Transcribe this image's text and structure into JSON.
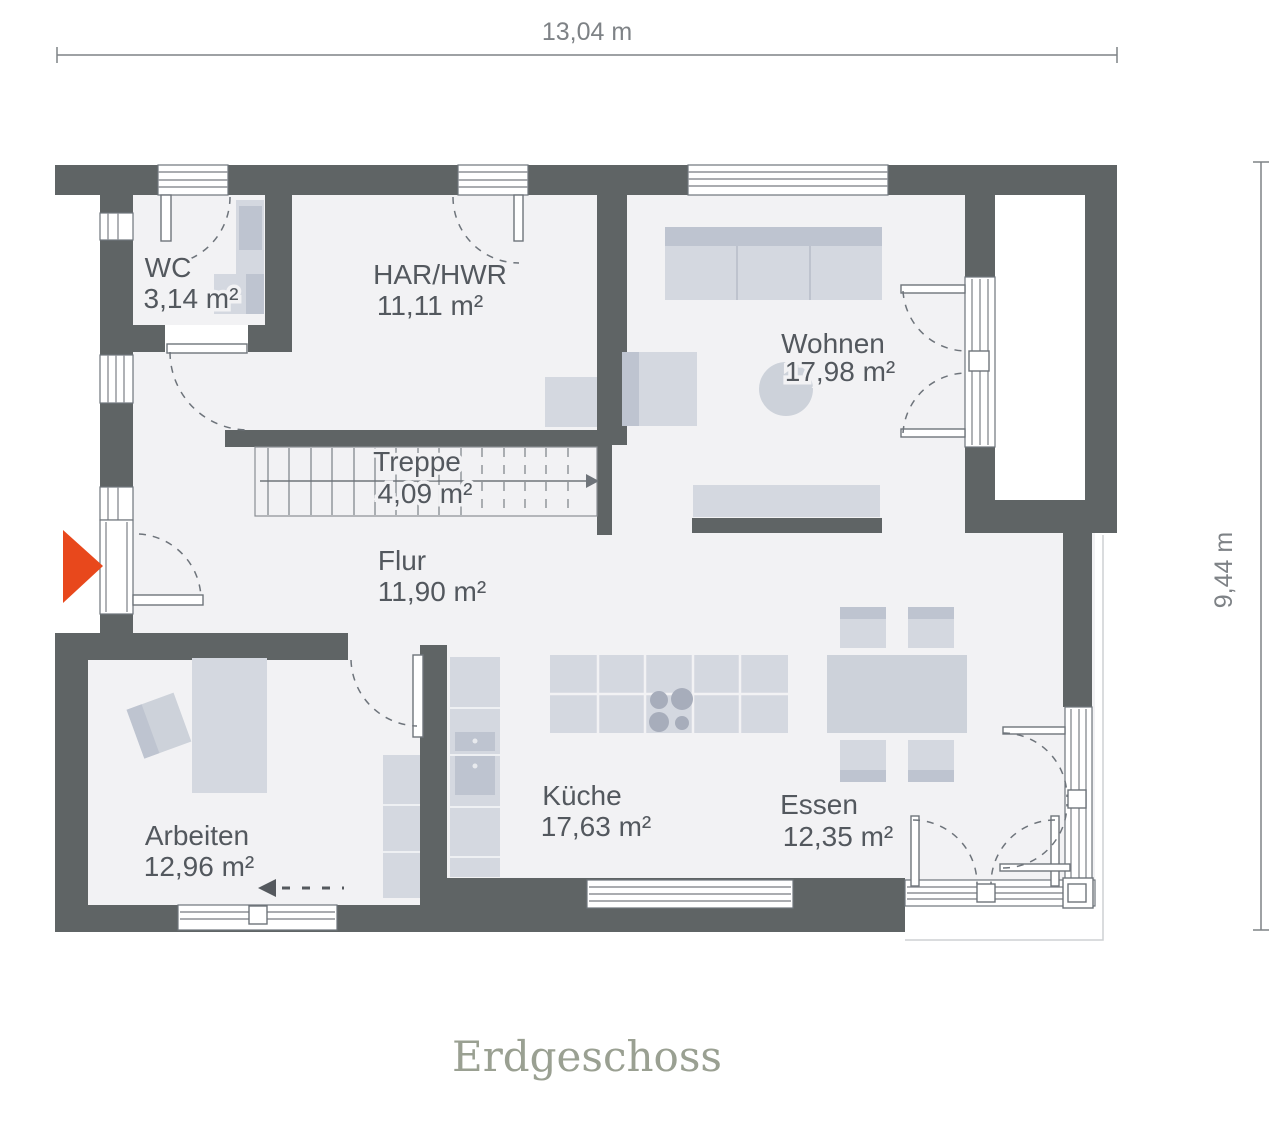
{
  "plan": {
    "title": "Erdgeschoss",
    "dim_width": "13,04 m",
    "dim_height": "9,44 m",
    "rooms": [
      {
        "name": "WC",
        "area": "3,14 m²"
      },
      {
        "name": "HAR/HWR",
        "area": "11,11 m²"
      },
      {
        "name": "Wohnen",
        "area": "17,98 m²"
      },
      {
        "name": "Treppe",
        "area": "4,09 m²"
      },
      {
        "name": "Flur",
        "area": "11,90 m²"
      },
      {
        "name": "Arbeiten",
        "area": "12,96 m²"
      },
      {
        "name": "Küche",
        "area": "17,63 m²"
      },
      {
        "name": "Essen",
        "area": "12,35 m²"
      }
    ]
  },
  "colors": {
    "wall": "#5f6465",
    "floor": "#f2f2f4",
    "outside": "#ffffff",
    "furn": "#d4d8e0",
    "furnDark": "#bec4d0",
    "furnMid": "#cdd2da",
    "frame": "#6e747b",
    "glaze": "#8d9196",
    "label": "#53585e",
    "dim": "#7e8286",
    "title": "#9aa092",
    "accent": "#e8481c",
    "burner": "#a7adbb"
  }
}
